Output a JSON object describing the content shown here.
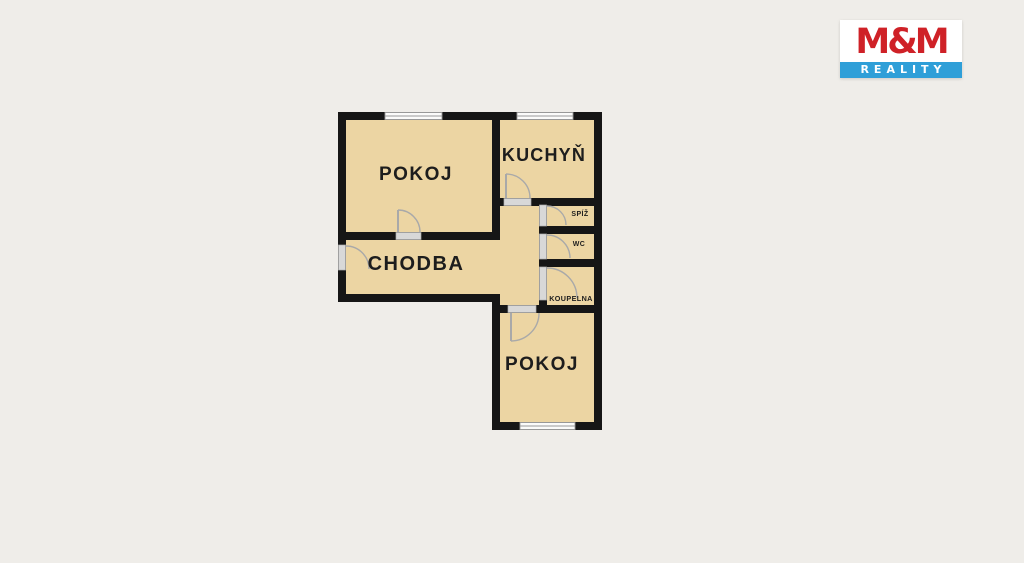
{
  "theme": {
    "background": "#efede9",
    "floor": "#ecd5a3",
    "wall": "#161616",
    "door": "#d8d8d8",
    "window_frame": "#9a9a9a",
    "arc": "#a9a9a9",
    "label": "#1d1d1d",
    "logo_red": "#cf2127",
    "logo_blue": "#2f9fd8",
    "logo_white": "#ffffff"
  },
  "logo": {
    "top_text": "M&M",
    "bottom_text": "REALITY"
  },
  "floor_plan": {
    "rooms": [
      {
        "id": "pokoj-1",
        "label": "POKOJ"
      },
      {
        "id": "kuchyn",
        "label": "KUCHYŇ"
      },
      {
        "id": "chodba",
        "label": "CHODBA"
      },
      {
        "id": "spiz",
        "label": "SPÍŽ"
      },
      {
        "id": "wc",
        "label": "WC"
      },
      {
        "id": "koupelna",
        "label": "KOUPELNA"
      },
      {
        "id": "pokoj-2",
        "label": "POKOJ"
      }
    ]
  }
}
